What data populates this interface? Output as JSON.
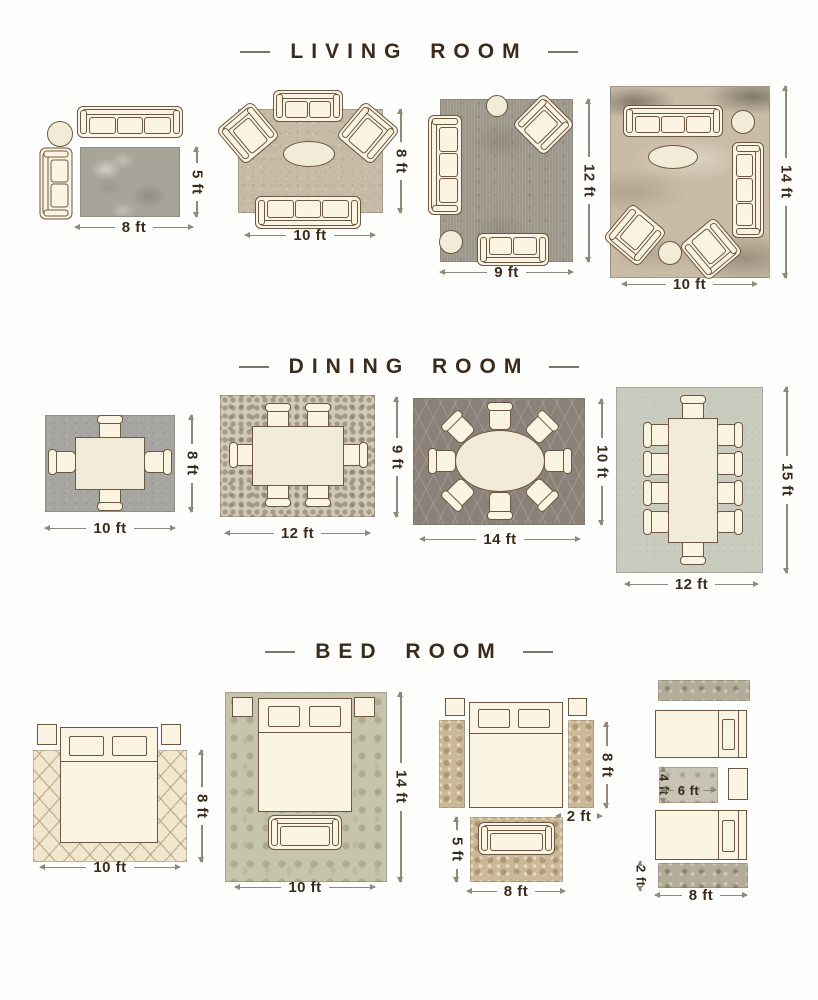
{
  "colors": {
    "background": "#fefefd",
    "label_text": "#3a2b1c",
    "dimension_line": "#8f897d",
    "furniture_outline": "#6d5740",
    "furniture_fill": "#fbf4e2"
  },
  "sections": [
    {
      "title": "LIVING ROOM",
      "layouts": [
        {
          "name": "sofa-with-accent-chair",
          "width_label": "8 ft",
          "height_label": "5 ft"
        },
        {
          "name": "sofa-loveseat-two-chairs",
          "width_label": "10 ft",
          "height_label": "8 ft"
        },
        {
          "name": "sofa-loveseat-chair",
          "width_label": "9 ft",
          "height_label": "12 ft"
        },
        {
          "name": "two-sofas-two-chairs",
          "width_label": "10 ft",
          "height_label": "14 ft"
        }
      ]
    },
    {
      "title": "DINING ROOM",
      "layouts": [
        {
          "name": "four-seat-table",
          "width_label": "10 ft",
          "height_label": "8 ft"
        },
        {
          "name": "six-seat-table",
          "width_label": "12 ft",
          "height_label": "9 ft"
        },
        {
          "name": "eight-seat-oval-table",
          "width_label": "14 ft",
          "height_label": "10 ft"
        },
        {
          "name": "ten-seat-table",
          "width_label": "12 ft",
          "height_label": "15 ft"
        }
      ]
    },
    {
      "title": "BED ROOM",
      "layouts": [
        {
          "name": "bed-on-area-rug",
          "width_label": "10 ft",
          "height_label": "8 ft"
        },
        {
          "name": "bed-on-large-rug",
          "width_label": "10 ft",
          "height_label": "14 ft"
        },
        {
          "name": "bed-with-side-runners",
          "runner_length_label": "8 ft",
          "runner_width_label": "2 ft",
          "foot_rug_height_label": "5 ft",
          "foot_rug_width_label": "8 ft"
        },
        {
          "name": "twin-beds-with-runners",
          "rug_height_label": "4 ft",
          "rug_width_label": "6 ft",
          "runner_height_label": "2 ft",
          "runner_width_label": "8 ft"
        }
      ]
    }
  ]
}
